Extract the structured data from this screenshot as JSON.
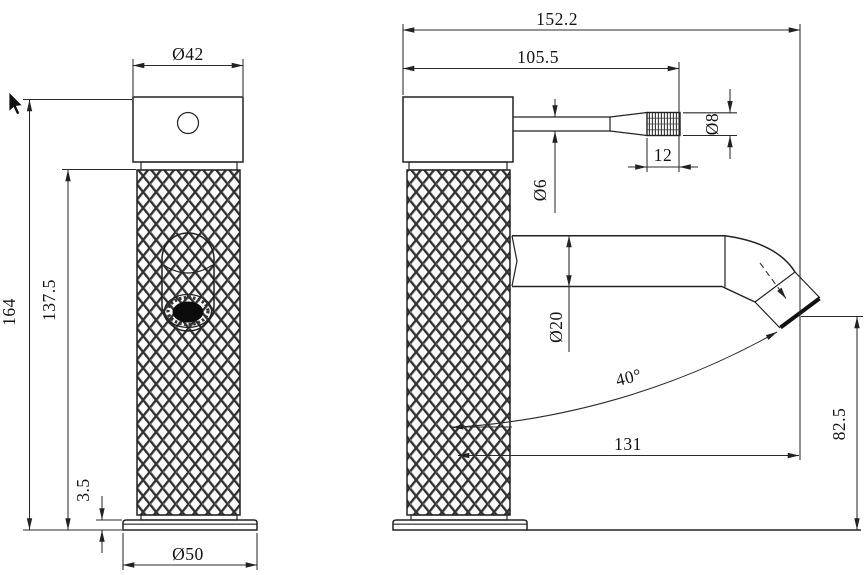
{
  "page": {
    "background": "#ffffff",
    "line_color": "#222222",
    "text_color": "#141414",
    "content": "faucet technical drawing, front and side orthographic views"
  },
  "front_view": {
    "dims": {
      "cap_diameter": "Ø42",
      "overall_height": "164",
      "body_height": "137.5",
      "base_height": "3.5",
      "base_diameter": "Ø50"
    }
  },
  "side_view": {
    "dims": {
      "overall_length": "152.2",
      "handle_reach": "105.5",
      "handle_stem_diameter": "Ø6",
      "handle_knob_length": "12",
      "handle_knob_diameter": "Ø8",
      "spout_diameter": "Ø20",
      "spout_angle": "40°",
      "spout_reach": "131",
      "outlet_height": "82.5"
    }
  }
}
